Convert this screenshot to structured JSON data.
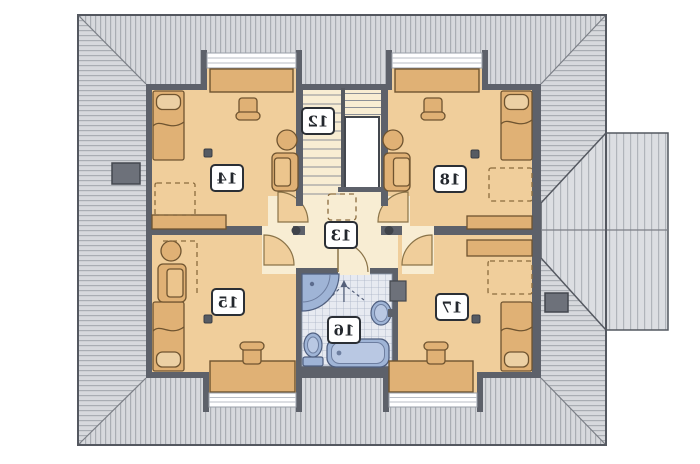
{
  "plan": {
    "name": "Attic floor plan (mirror-printed)",
    "rooms": [
      {
        "label": "12",
        "name": "staircase"
      },
      {
        "label": "13",
        "name": "hallway"
      },
      {
        "label": "14",
        "name": "room top-left"
      },
      {
        "label": "15",
        "name": "room bottom-left"
      },
      {
        "label": "16",
        "name": "bathroom"
      },
      {
        "label": "17",
        "name": "room bottom-right"
      },
      {
        "label": "18",
        "name": "room top-right"
      }
    ],
    "bathroom_fixtures": [
      "corner-shower",
      "washbasin",
      "toilet",
      "bathtub"
    ],
    "furniture_types": [
      "bed",
      "desk",
      "desk-chair",
      "armchair",
      "round-table",
      "dresser"
    ],
    "window_count": 4,
    "chimney_count": 2,
    "colors": {
      "roof": "#d7d9dd",
      "roof_stripe": "#a9adb3",
      "roof_outline": "#545860",
      "wall": "#5d616a",
      "room_floor": "#f0ce9b",
      "hall_floor": "#f8edd3",
      "furniture": "#e0b175",
      "furniture_outline": "#6f5430",
      "bath_fixture": "#9fb4d6",
      "bath_fixture_inner": "#b9c8e3",
      "bath_tile": "#e7eaf1",
      "chimney": "#6d717a",
      "label_box_border": "#2b2f35"
    }
  }
}
